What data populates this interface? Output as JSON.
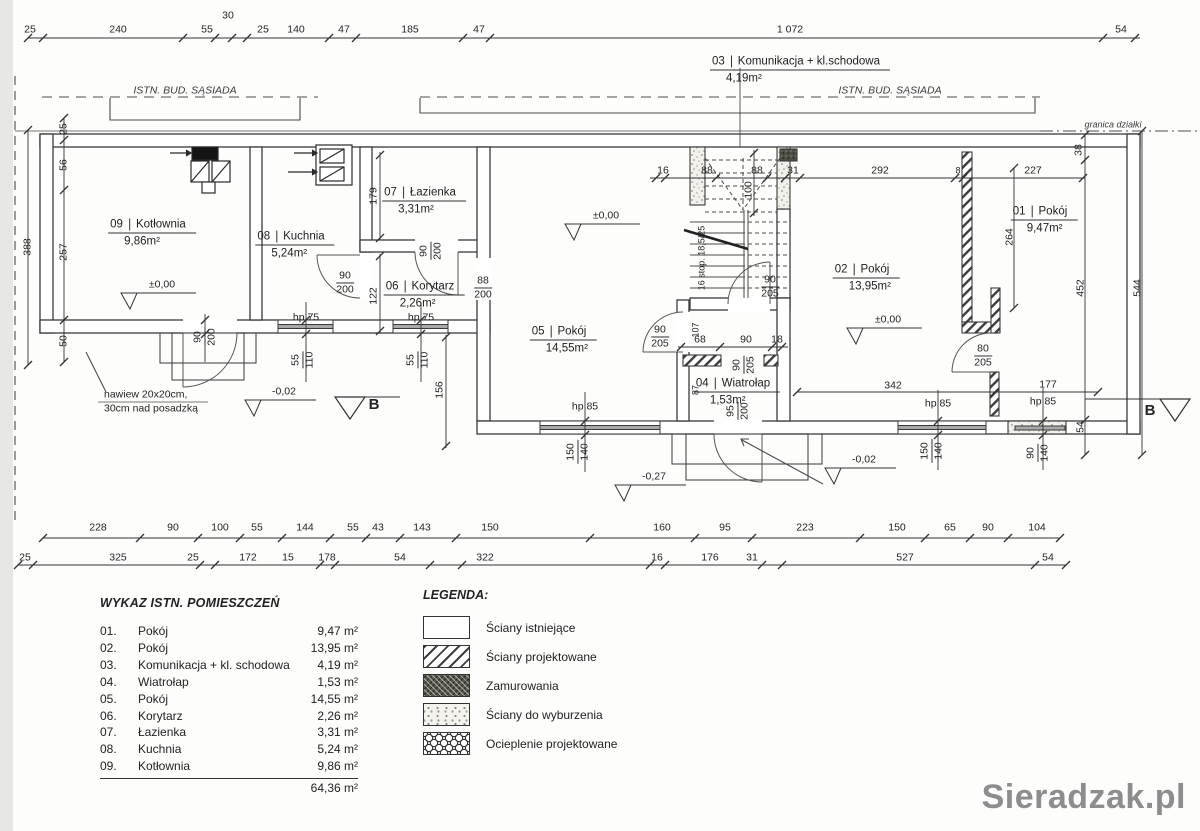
{
  "plan": {
    "labels": {
      "neighbor_left": "ISTN. BUD. SĄSIADA",
      "neighbor_right": "ISTN. BUD. SĄSIADA",
      "boundary": "granica działki",
      "vent_note_1": "nawiew 20x20cm,",
      "vent_note_2": "30cm nad posadzką",
      "stairs_note": "16 stop. 18,5/25",
      "section": "B",
      "level_zero": "±0,00",
      "level_m02": "-0,02",
      "level_m27": "-0,27"
    },
    "rooms": [
      {
        "no": "01",
        "name": "Pokój",
        "area": "9,47m²"
      },
      {
        "no": "02",
        "name": "Pokój",
        "area": "13,95m²"
      },
      {
        "no": "03",
        "name": "Komunikacja + kl.schodowa",
        "area": "4,19m²"
      },
      {
        "no": "04",
        "name": "Wiatrołap",
        "area": "1,53m²"
      },
      {
        "no": "05",
        "name": "Pokój",
        "area": "14,55m²"
      },
      {
        "no": "06",
        "name": "Korytarz",
        "area": "2,26m²"
      },
      {
        "no": "07",
        "name": "Łazienka",
        "area": "3,31m²"
      },
      {
        "no": "08",
        "name": "Kuchnia",
        "area": "5,24m²"
      },
      {
        "no": "09",
        "name": "Kotłownia",
        "area": "9,86m²"
      }
    ],
    "dims": {
      "top": [
        "25",
        "240",
        "55",
        "30",
        "25",
        "140",
        "47",
        "185",
        "47",
        "1 072",
        "54"
      ],
      "bottom1": [
        "228",
        "90",
        "100",
        "55",
        "144",
        "55",
        "43",
        "143",
        "150",
        "160",
        "95",
        "223",
        "150",
        "65",
        "90",
        "104"
      ],
      "bottom2": [
        "25",
        "325",
        "25",
        "172",
        "15",
        "178",
        "54",
        "322",
        "16",
        "176",
        "31",
        "527",
        "54"
      ],
      "left": [
        "388",
        "25",
        "56",
        "257",
        "50"
      ],
      "right": [
        "38",
        "264",
        "452",
        "544",
        "54"
      ],
      "stair": [
        "16",
        "88",
        "88",
        "31",
        "100"
      ],
      "right_top": [
        "292",
        "8",
        "227"
      ],
      "inner": [
        "68",
        "90",
        "18",
        "342",
        "177",
        "179",
        "122",
        "156",
        "107",
        "87"
      ]
    },
    "openings": {
      "fracs": [
        {
          "num": "90",
          "den": "200"
        },
        {
          "num": "88",
          "den": "200"
        },
        {
          "num": "90",
          "den": "205"
        },
        {
          "num": "90",
          "den": "205"
        },
        {
          "num": "80",
          "den": "205"
        },
        {
          "num": "90",
          "den": "200"
        },
        {
          "num": "90",
          "den": "200"
        },
        {
          "num": "90",
          "den": "205"
        },
        {
          "num": "95",
          "den": "200"
        },
        {
          "num": "55",
          "den": "110"
        },
        {
          "num": "55",
          "den": "110"
        },
        {
          "num": "150",
          "den": "140"
        },
        {
          "num": "150",
          "den": "140"
        },
        {
          "num": "90",
          "den": "140"
        }
      ],
      "sills": [
        "hp 75",
        "hp 75",
        "hp 85",
        "hp 85",
        "hp 85"
      ]
    }
  },
  "schedule": {
    "title": "WYKAZ ISTN. POMIESZCZEŃ",
    "rows": [
      {
        "no": "01.",
        "name": "Pokój",
        "area": "9,47 m²"
      },
      {
        "no": "02.",
        "name": "Pokój",
        "area": "13,95 m²"
      },
      {
        "no": "03.",
        "name": "Komunikacja + kl. schodowa",
        "area": "4,19 m²"
      },
      {
        "no": "04.",
        "name": "Wiatrołap",
        "area": "1,53 m²"
      },
      {
        "no": "05.",
        "name": "Pokój",
        "area": "14,55 m²"
      },
      {
        "no": "06.",
        "name": "Korytarz",
        "area": "2,26 m²"
      },
      {
        "no": "07.",
        "name": "Łazienka",
        "area": "3,31 m²"
      },
      {
        "no": "08.",
        "name": "Kuchnia",
        "area": "5,24 m²"
      },
      {
        "no": "09.",
        "name": "Kotłownia",
        "area": "9,86 m²"
      }
    ],
    "total": "64,36 m²"
  },
  "legend": {
    "title": "LEGENDA:",
    "items": [
      {
        "label": "Ściany istniejące"
      },
      {
        "label": "Ściany projektowane"
      },
      {
        "label": "Zamurowania"
      },
      {
        "label": "Ściany do wyburzenia"
      },
      {
        "label": "Ocieplenie projektowane"
      }
    ]
  },
  "watermark": "Sieradzak.pl"
}
